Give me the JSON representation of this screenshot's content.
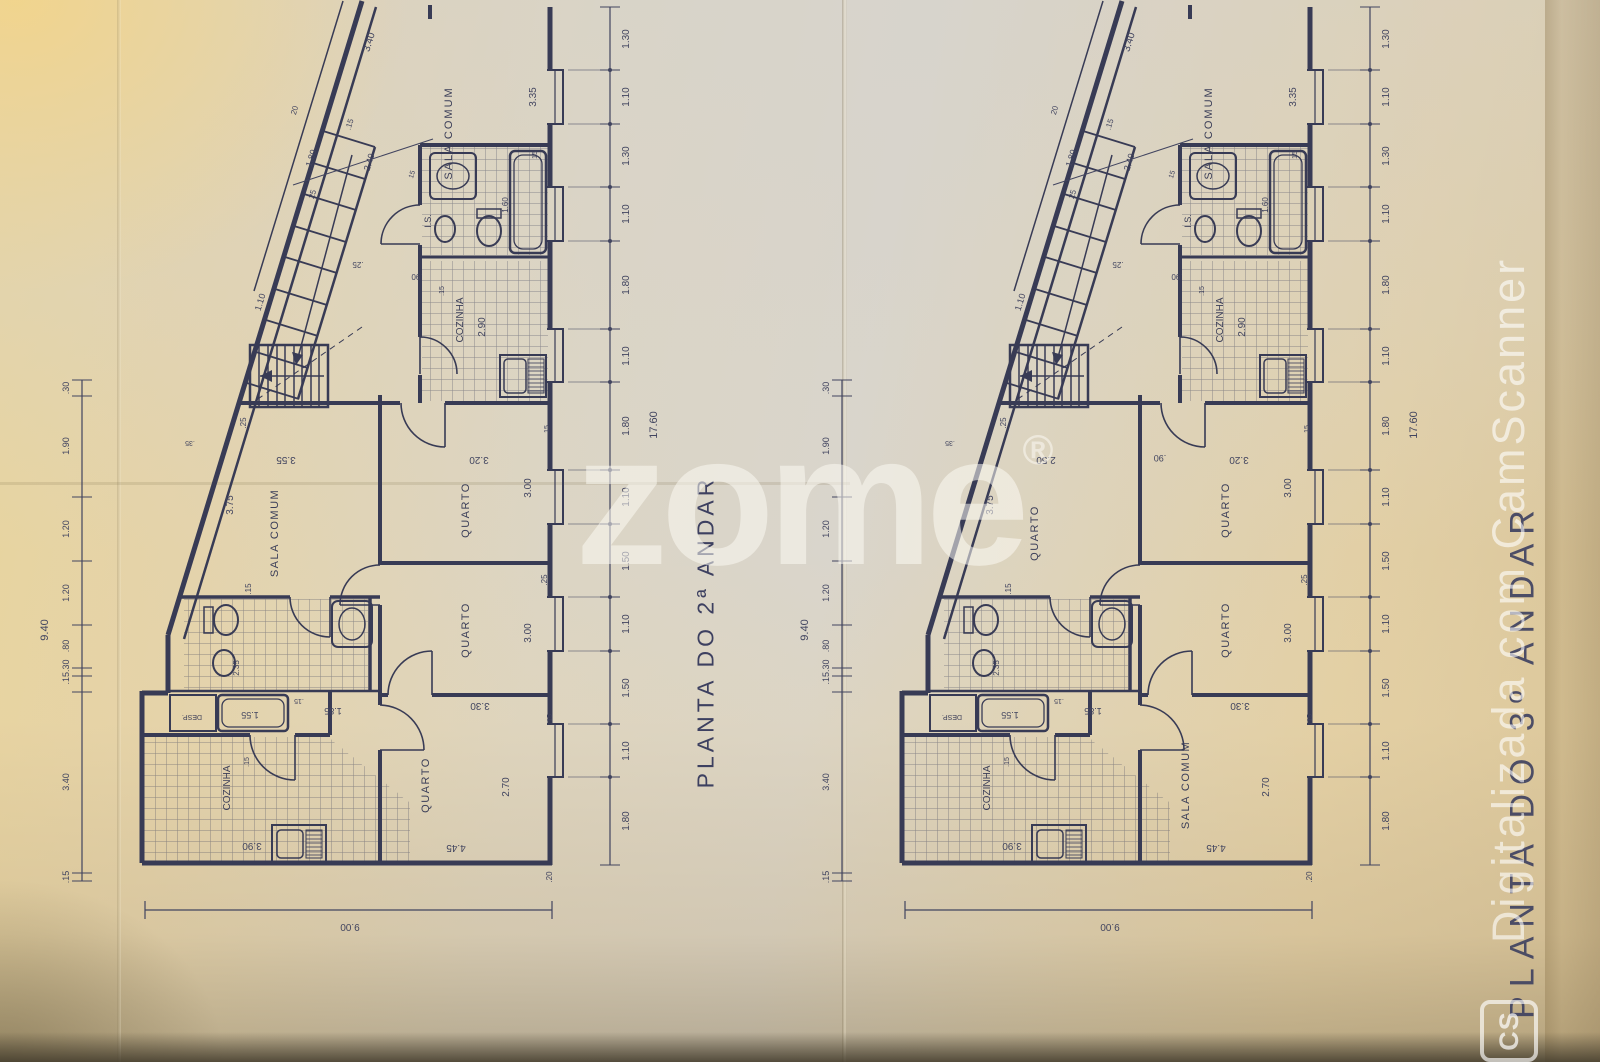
{
  "page": {
    "watermark": "zome",
    "watermark_reg": "®",
    "camscanner_text": "Digitalizada com CamScanner",
    "camscanner_logo": "CS",
    "ink_color": "#3b3e58",
    "paper_color": "#e2d2a9"
  },
  "shared": {
    "right_chain": [
      "1.30",
      "1.10",
      "1.30",
      "1.10",
      "1.80",
      "1.10",
      "1.80",
      "1.10",
      "1.50",
      "1.10",
      "1.50",
      "1.10",
      "1.80"
    ],
    "right_total": "17.60",
    "left_chain": [
      ".30",
      "1.90",
      "1.20",
      "1.20",
      ".80",
      ".15.30",
      "3.40",
      ".15"
    ],
    "left_total": "9.40",
    "bottom_total": "9.00",
    "facade": {
      "d340": "3.40",
      "d15": ".15",
      "d20": "20",
      "d180": "1.80",
      "d240": "2.40",
      "d25": "25",
      "d15b": "15"
    },
    "stairs": {
      "d110": "1.10",
      "d25": ".25",
      "d90": ".90"
    },
    "top_room": {
      "label": "SALA COMUM",
      "d335": "3.35",
      "d15": "15"
    },
    "is_room": {
      "label": "I.S.",
      "d160": "1.60"
    },
    "kitchen_top": {
      "label": "COZINHA",
      "d290": "2.90",
      "d15": ".15"
    },
    "mid": {
      "d25": ".25",
      "d35": ".35",
      "d15": ".15"
    },
    "q1": {
      "label": "QUARTO",
      "d300": "3.00",
      "d320": "3.20",
      "d15": ".15"
    },
    "q2": {
      "label": "QUARTO",
      "d300": "3.00",
      "d25": ".25"
    },
    "bottom_room": {
      "d330": "3.30",
      "d270": "2.70",
      "d445": "4.45",
      "d15": ".15",
      "d20": ".20"
    },
    "bath_mid": {
      "d155": "1.55",
      "d185": "1.85",
      "d15": ".15",
      "d235": "2.35",
      "desp": "DESP."
    },
    "kitchen_bottom": {
      "label": "COZINHA",
      "d390": "3.90",
      "d15": ".15"
    }
  },
  "plans": {
    "left": {
      "title": "PLANTA DO 2ª ANDAR",
      "mid_room": "SALA COMUM",
      "mid_w": "3.75",
      "mid_top": "3.55",
      "mid_top2": "",
      "bottom_room": "QUARTO"
    },
    "right": {
      "title": "PLANTA DO 3º ANDAR",
      "mid_room": "QUARTO",
      "mid_w": "3.75",
      "mid_top": "2.50",
      "mid_top2": ".90",
      "bottom_room": "SALA COMUM"
    }
  }
}
